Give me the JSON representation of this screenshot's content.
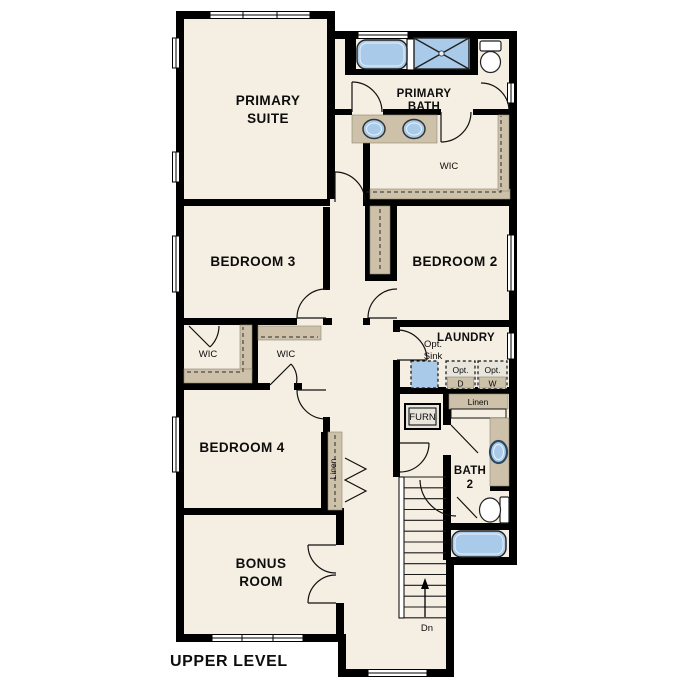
{
  "plan": {
    "title": "UPPER LEVEL",
    "labels": {
      "primary_suite_1": "PRIMARY",
      "primary_suite_2": "SUITE",
      "primary_bath_1": "PRIMARY",
      "primary_bath_2": "BATH",
      "primary_wic": "WIC",
      "bedroom3": "BEDROOM 3",
      "bedroom2": "BEDROOM 2",
      "bedroom4": "BEDROOM 4",
      "wic_bedroom3": "WIC",
      "wic_bedroom4": "WIC",
      "laundry": "LAUNDRY",
      "opt_sink_1": "Opt.",
      "opt_sink_2": "Sink",
      "opt_dryer_1": "Opt.",
      "opt_dryer_2": "D",
      "opt_washer_1": "Opt.",
      "opt_washer_2": "W",
      "linen_laundry": "Linen",
      "furnace": "FURN",
      "linen_hall": "Linen",
      "bath2_1": "BATH",
      "bath2_2": "2",
      "bonus_1": "BONUS",
      "bonus_2": "ROOM",
      "stairs_dir": "Dn"
    },
    "colors": {
      "floor": "#f5eee2",
      "wall": "#000000",
      "casework": "#cdc1aa",
      "fixture_blue": "#a9cbe9",
      "optional_fill": "#e8e5dd",
      "background": "#ffffff"
    }
  }
}
